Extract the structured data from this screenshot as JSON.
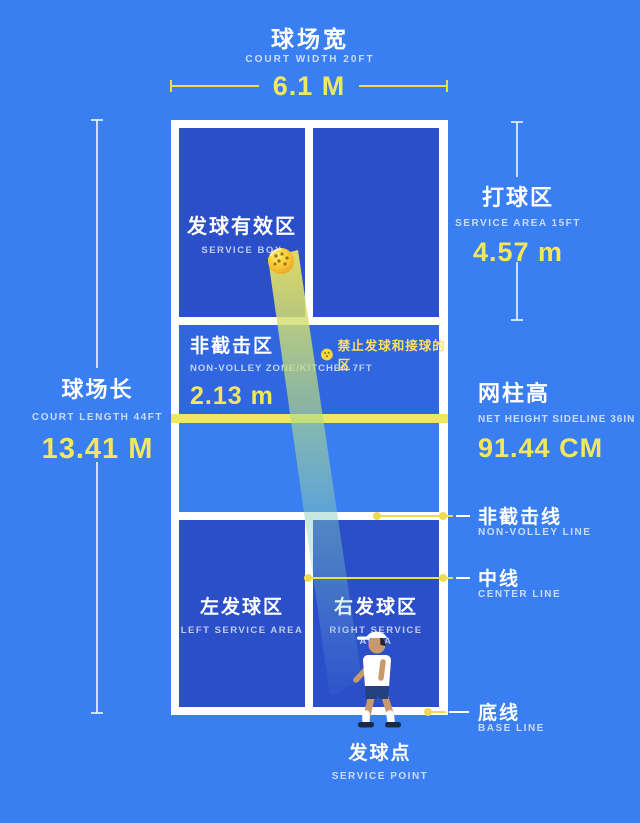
{
  "colors": {
    "background_blue": "#3a7ff2",
    "service_box_blue": "#2b4fc9",
    "kitchen_blue": "#3067e0",
    "line_white": "#ffffff",
    "accent_yellow": "#f2e75e",
    "net_yellow": "#f0e85c",
    "ball_yellow": "#f8cf38"
  },
  "header": {
    "title": "球场宽",
    "subtitle": "COURT WIDTH 20FT",
    "value": "6.1 M"
  },
  "court_length": {
    "title": "球场长",
    "subtitle": "COURT LENGTH 44FT",
    "value": "13.41 M"
  },
  "service_area": {
    "title": "打球区",
    "subtitle": "SERVICE AREA 15FT",
    "value": "4.57 m"
  },
  "net_height": {
    "title": "网柱高",
    "subtitle": "NET HEIGHT SIDELINE 36IN",
    "value": "91.44 CM"
  },
  "service_box": {
    "title": "发球有效区",
    "subtitle": "SERVICE BOX"
  },
  "kitchen": {
    "title": "非截击区",
    "subtitle": "NON-VOLLEY ZONE/KITCHEN 7FT",
    "value": "2.13 m",
    "note": "禁止发球和接球的区"
  },
  "left_service_area": {
    "title": "左发球区",
    "subtitle": "LEFT SERVICE AREA"
  },
  "right_service_area": {
    "title": "右发球区",
    "subtitle": "RIGHT SERVICE AREA"
  },
  "callouts": [
    {
      "title": "非截击线",
      "subtitle": "NON-VOLLEY LINE"
    },
    {
      "title": "中线",
      "subtitle": "CENTER LINE"
    },
    {
      "title": "底线",
      "subtitle": "BASE LINE"
    }
  ],
  "service_point": {
    "title": "发球点",
    "subtitle": "SERVICE POINT"
  }
}
